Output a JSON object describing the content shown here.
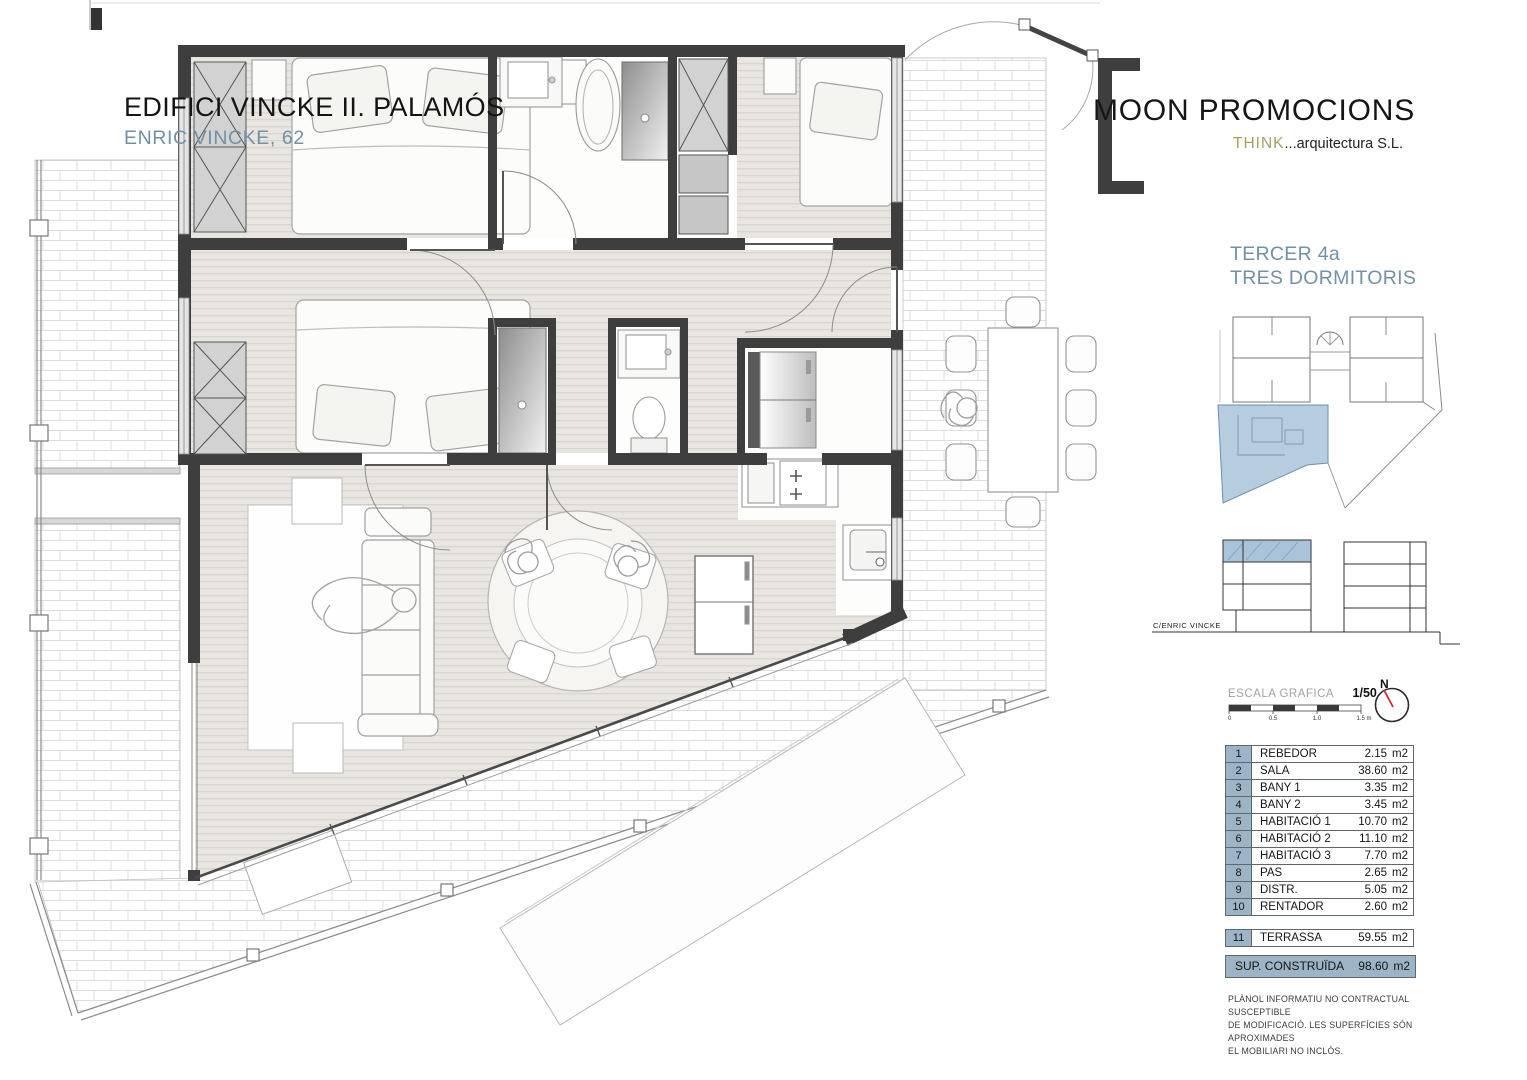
{
  "header": {
    "title": "EDIFICI VINCKE II. PALAMÓS",
    "subtitle": "ENRIC VINCKE, 62"
  },
  "brand": {
    "company": "MOON PROMOCIONS",
    "studio_accent": "THINK",
    "studio_rest": "...arquitectura S.L."
  },
  "unit": {
    "name": "TERCER 4a",
    "type": "TRES DORMITORIS"
  },
  "elevation": {
    "street_label": "C/ENRIC VINCKE"
  },
  "scale": {
    "label": "ESCALA GRAFICA",
    "ratio": "1/50",
    "ticks": [
      "0",
      "0.5",
      "1.0",
      "1.5 m"
    ]
  },
  "north": {
    "label": "N"
  },
  "area_table": {
    "unit_suffix": "m2",
    "rows": [
      {
        "num": "1",
        "name": "REBEDOR",
        "area": "2.15"
      },
      {
        "num": "2",
        "name": "SALA",
        "area": "38.60"
      },
      {
        "num": "3",
        "name": "BANY 1",
        "area": "3.35"
      },
      {
        "num": "4",
        "name": "BANY 2",
        "area": "3.45"
      },
      {
        "num": "5",
        "name": "HABITACIÓ 1",
        "area": "10.70"
      },
      {
        "num": "6",
        "name": "HABITACIÓ 2",
        "area": "11.10"
      },
      {
        "num": "7",
        "name": "HABITACIÓ 3",
        "area": "7.70"
      },
      {
        "num": "8",
        "name": "PAS",
        "area": "2.65"
      },
      {
        "num": "9",
        "name": "DISTR.",
        "area": "5.05"
      },
      {
        "num": "10",
        "name": "RENTADOR",
        "area": "2.60"
      }
    ],
    "terrace_row": {
      "num": "11",
      "name": "TERRASSA",
      "area": "59.55"
    },
    "total_row": {
      "name": "SUP. CONSTRUÏDA",
      "area": "98.60"
    }
  },
  "disclaimer": {
    "line1": "PLÀNOL  INFORMATIU NO CONTRACTUAL  SUSCEPTIBLE",
    "line2": "DE MODIFICACIÓ. LES SUPERFÍCIES SÓN APROXIMADES",
    "line3": "EL MOBILIARI NO INCLÒS."
  },
  "colors": {
    "wall_dark": "#3f3e3e",
    "highlight_blue": "#a9c4da",
    "label_blue": "#7391a5",
    "accent_olive": "#a5a060",
    "table_blue": "#9db4c6"
  }
}
